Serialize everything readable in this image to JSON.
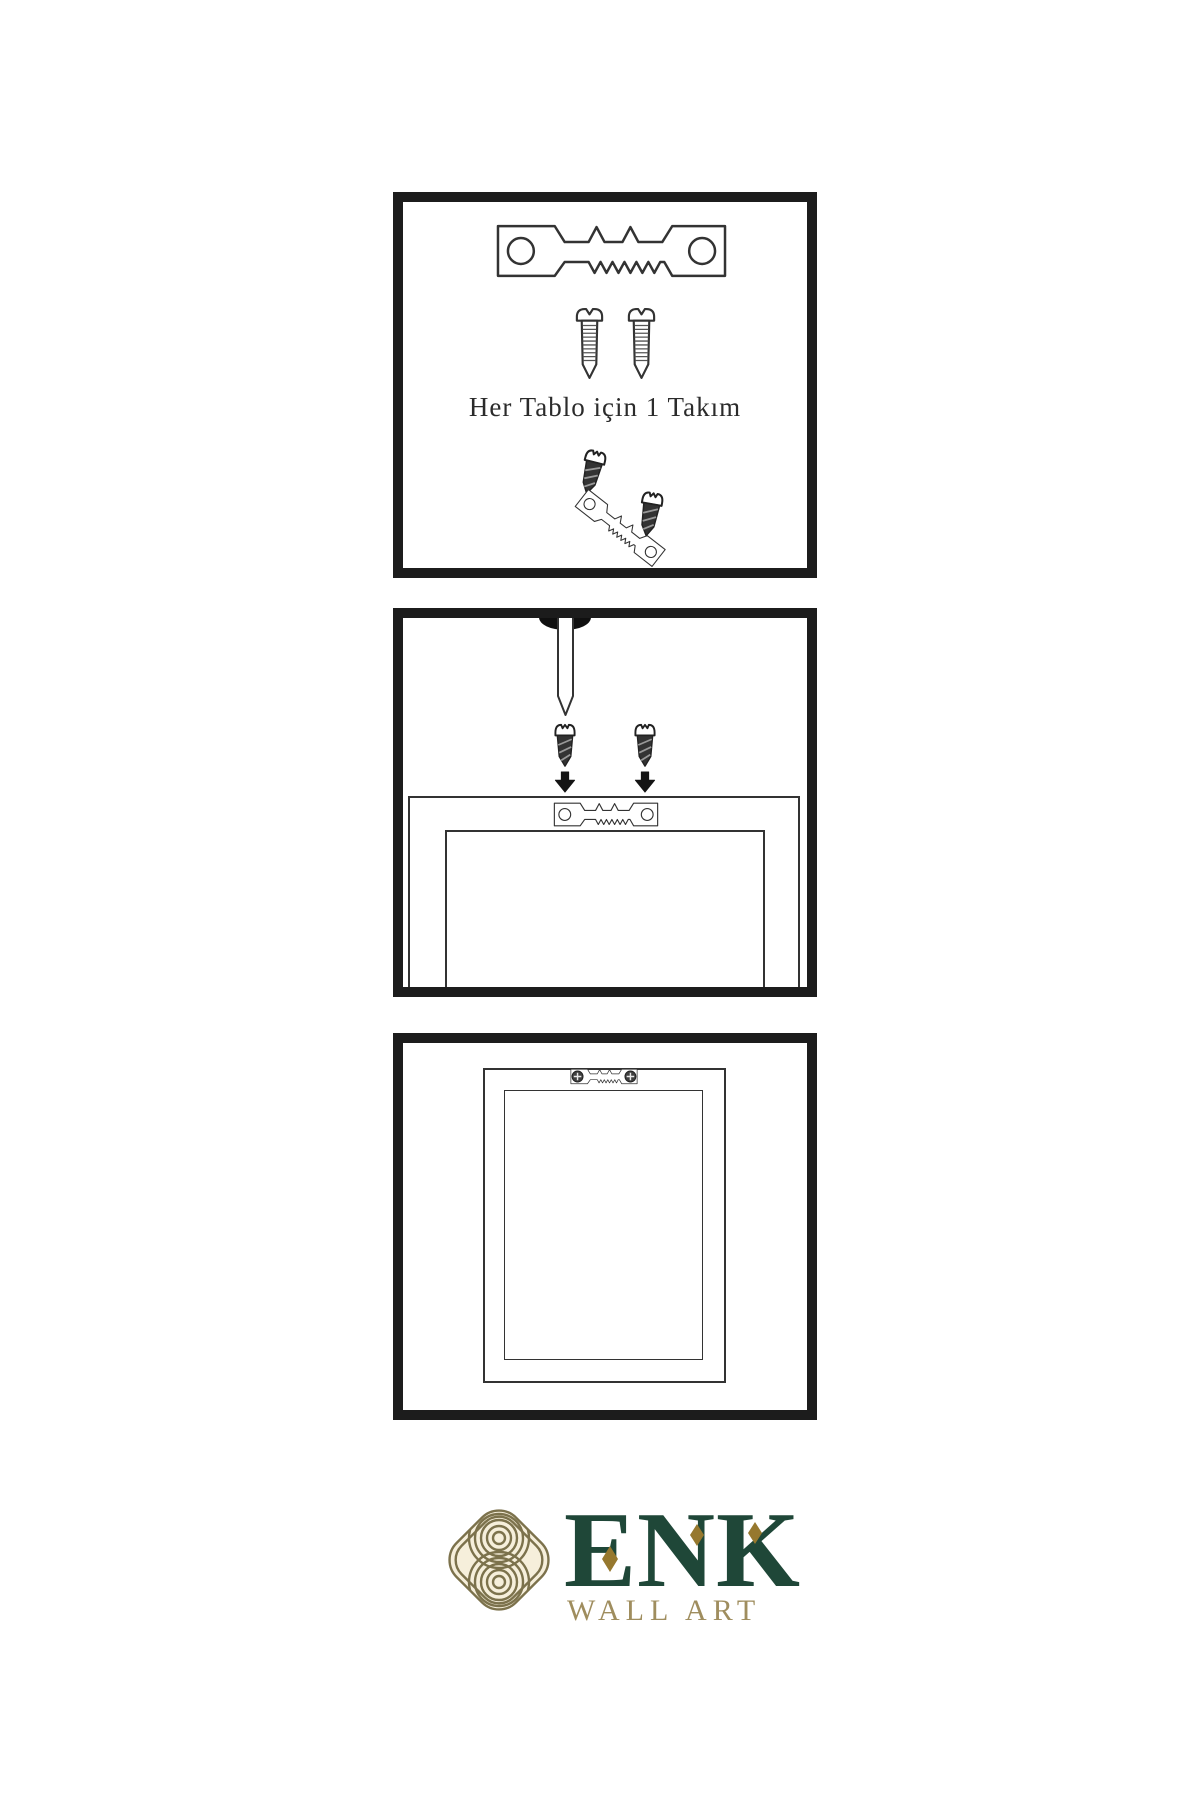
{
  "page": {
    "background": "#ffffff",
    "diagram_line_color": "#333333",
    "panel_border_color": "#1c1c1c"
  },
  "steps": [
    {
      "name": "hardware-set",
      "caption": "Her Tablo için 1 Takım",
      "items": [
        "sawtooth-hanger",
        "screw",
        "screw",
        "screw",
        "tilted-sawtooth-hanger",
        "screw"
      ]
    },
    {
      "name": "attach-hanger-to-frame-back",
      "caption": "",
      "items": [
        "wall-nail",
        "screw",
        "screw",
        "arrow-down",
        "arrow-down",
        "sawtooth-hanger",
        "frame-back"
      ]
    },
    {
      "name": "hanger-mounted-on-frame",
      "caption": "",
      "items": [
        "sawtooth-hanger-with-screws",
        "frame-back"
      ]
    }
  ],
  "brand": {
    "name": "ENK",
    "tagline": "WALL ART",
    "colors": {
      "name_green": "#1f4738",
      "diamond_gold": "#96782e",
      "tagline_gold": "#9f8d5e",
      "knot_line": "#7c724c",
      "knot_background": "#f6efdb"
    }
  },
  "icons": {
    "hanger": "sawtooth-hanger-icon",
    "screw_outline": "machine-screw-icon",
    "screw_dark": "wood-screw-icon",
    "arrow": "arrow-down-icon",
    "nail": "wall-nail-icon",
    "phillips": "phillips-screw-head-icon",
    "knot": "enk-knot-monogram-icon"
  }
}
